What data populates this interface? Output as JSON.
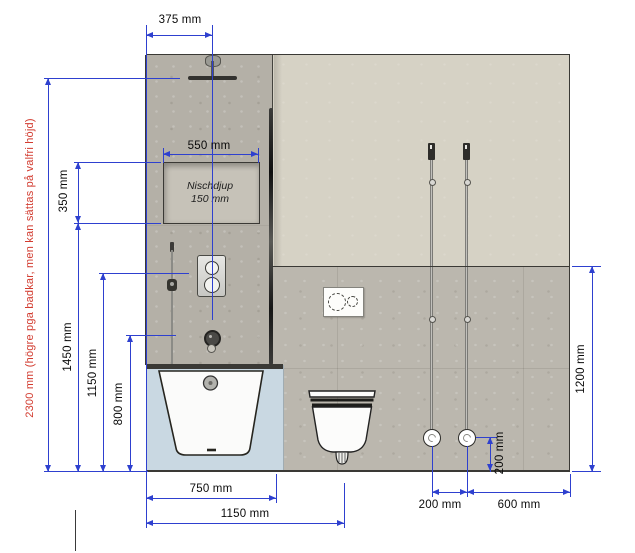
{
  "drawing": {
    "note_2300": "2300 mm (högre pga badkar, men kan sättas på valfri höjd)",
    "niche": {
      "line1": "Nischdjup",
      "line2": "150 mm"
    },
    "dims": {
      "top_375": "375 mm",
      "niche_550": "550 mm",
      "left_350": "350 mm",
      "left_1450": "1450 mm",
      "left_1150": "1150 mm",
      "left_800": "800 mm",
      "bottom_750": "750 mm",
      "bottom_1150": "1150 mm",
      "right_1200": "1200 mm",
      "outlet_height_200": "200 mm",
      "bottom_200": "200 mm",
      "bottom_600": "600 mm"
    },
    "colors": {
      "dimension_blue": "#2e40cf",
      "note_red": "#d23b2f",
      "upper_wall_beige": "#d6d2c5",
      "shower_wall_gray": "#b4b0a7",
      "tile_gray": "#bbb7ae",
      "tub_backdrop_blue": "#c9d8e2"
    }
  }
}
